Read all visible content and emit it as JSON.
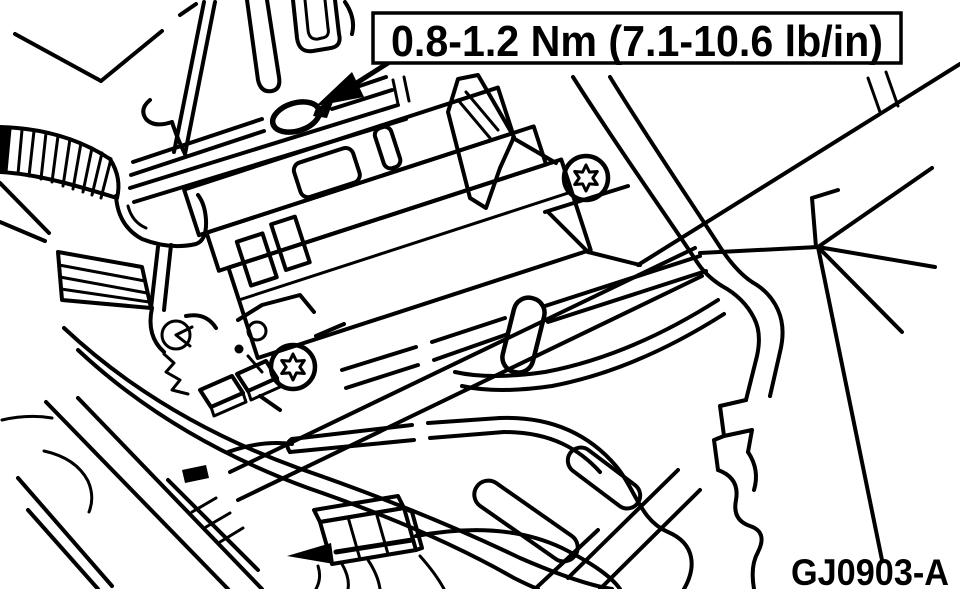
{
  "figure": {
    "type": "technical-line-illustration",
    "callout_text": "0.8-1.2 Nm (7.1-10.6 lb/in)",
    "figure_code": "GJ0903-A",
    "colors": {
      "ink": "#000000",
      "paper": "#ffffff"
    },
    "icons": {
      "torque_arrow": "filled-arrowhead-pointing-to-fastener",
      "lower_arrow": "filled-arrowhead-pointing-to-connector",
      "torx_screw": "circle-with-6-point-star",
      "grommet": "bold-ellipse-screw-hole"
    }
  }
}
